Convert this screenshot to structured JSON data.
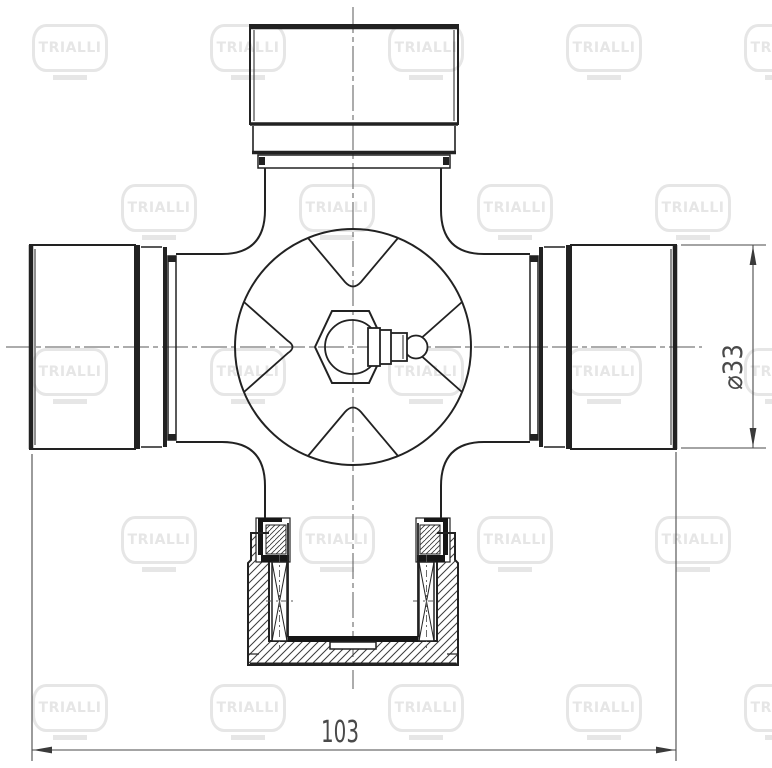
{
  "document": {
    "kind": "technical-drawing",
    "part": "universal-joint-cross-with-bearing-cups",
    "background_color": "#ffffff",
    "line_color": "#222222",
    "dim_color": "#4a4a4a",
    "centerline_color": "#5a5a5a"
  },
  "watermark": {
    "text": "TRIALLI",
    "color": "#e6e6e6"
  },
  "dimensions": {
    "length": {
      "label": "103"
    },
    "diameter": {
      "label": "⌀33"
    }
  }
}
